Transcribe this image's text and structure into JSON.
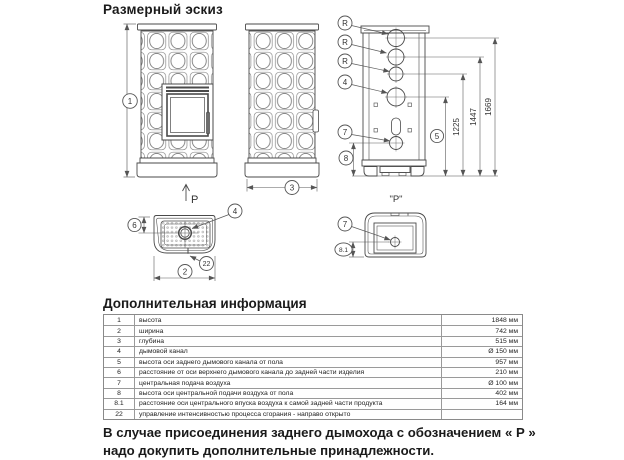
{
  "title": "Размерный эскиз",
  "drawing": {
    "labels": {
      "height": "1",
      "width": "2",
      "depth": "3",
      "flue": "4",
      "rear_flue_height": "5",
      "flue_rear_offset": "6",
      "central_air": "7",
      "air_height": "8",
      "air_rear_offset": "8.1",
      "combustion_control": "22",
      "flue_ring": "R",
      "rear_arrow": "P",
      "rear_detail": "\"Р\"",
      "dim_1225": "1225",
      "dim_1447": "1447",
      "dim_1669": "1669"
    }
  },
  "table": {
    "title": "Дополнительная информация",
    "rows": [
      {
        "num": "1",
        "desc": "высота",
        "value": "1848 мм"
      },
      {
        "num": "2",
        "desc": "ширина",
        "value": "742 мм"
      },
      {
        "num": "3",
        "desc": "глубина",
        "value": "515 мм"
      },
      {
        "num": "4",
        "desc": "дымовой канал",
        "value": "Ø 150 мм"
      },
      {
        "num": "5",
        "desc": "высота оси заднего дымового канала от пола",
        "value": "957 мм"
      },
      {
        "num": "6",
        "desc": "расстояние от оси верхнего дымового канала до задней части изделия",
        "value": "210 мм"
      },
      {
        "num": "7",
        "desc": "центральная подача воздуха",
        "value": "Ø 100 мм"
      },
      {
        "num": "8",
        "desc": "высота оси центральной подачи воздуха от пола",
        "value": "402 мм"
      },
      {
        "num": "8.1",
        "desc": "расстояние оси центрального впуска воздуха к самой задней части продукта",
        "value": "164 мм"
      },
      {
        "num": "22",
        "desc": "управление интенсивностью процесса сгорания - направо открыто",
        "value": ""
      }
    ]
  },
  "note": {
    "line1": "В случае присоединения заднего дымохода с обозначением « Р »",
    "line2": "надо докупить дополнительные принадлежности."
  }
}
